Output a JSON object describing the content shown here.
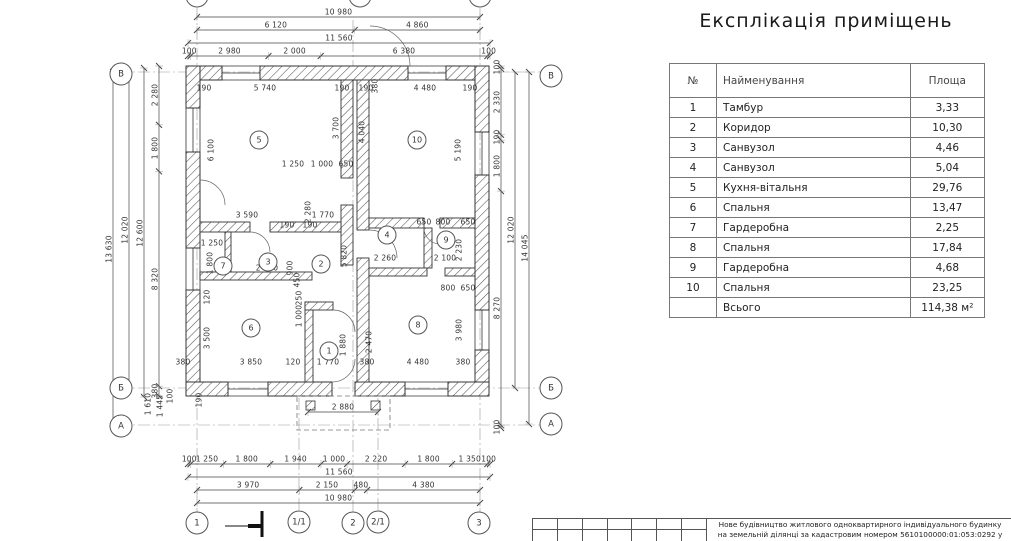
{
  "title": "Експлікація приміщень",
  "table": {
    "headers": [
      "№",
      "Найменування",
      "Площа"
    ],
    "rows": [
      [
        "1",
        "Тамбур",
        "3,33"
      ],
      [
        "2",
        "Коридор",
        "10,30"
      ],
      [
        "3",
        "Санвузол",
        "4,46"
      ],
      [
        "4",
        "Санвузол",
        "5,04"
      ],
      [
        "5",
        "Кухня-вітальня",
        "29,76"
      ],
      [
        "6",
        "Спальня",
        "13,47"
      ],
      [
        "7",
        "Гардеробна",
        "2,25"
      ],
      [
        "8",
        "Спальня",
        "17,84"
      ],
      [
        "9",
        "Гардеробна",
        "4,68"
      ],
      [
        "10",
        "Спальня",
        "23,25"
      ]
    ],
    "footer": {
      "label": "Всього",
      "value": "114,38 м²"
    }
  },
  "title_block": {
    "line1": "Нове будівництво житлового одноквартирного індивідуального будинку",
    "line2": "на земельній ділянці за кадастровим номером 5610100000:01:053:0292 у"
  },
  "chains": [
    {
      "dir": "h",
      "y": 17,
      "a": 197,
      "b": 480,
      "vals": [
        "10 980"
      ]
    },
    {
      "dir": "h",
      "y": 30,
      "a": 197,
      "b": 480,
      "vals": [
        "6 120",
        "4 860"
      ]
    },
    {
      "dir": "h",
      "y": 43,
      "a": 188,
      "b": 490,
      "vals": [
        "11 560"
      ]
    },
    {
      "dir": "h",
      "y": 56,
      "a": 188,
      "b": 490,
      "vals": [
        "100",
        "2 980",
        "2 000",
        "6 380",
        "100"
      ]
    },
    {
      "dir": "h",
      "y": 412,
      "a": 308,
      "b": 378,
      "vals": [
        "2 880"
      ]
    },
    {
      "dir": "h",
      "y": 464,
      "a": 188,
      "b": 490,
      "vals": [
        "100",
        "1 250",
        "1 800",
        "1 940",
        "1 000",
        "2 220",
        "1 800",
        "1 350",
        "100"
      ]
    },
    {
      "dir": "h",
      "y": 477,
      "a": 188,
      "b": 490,
      "vals": [
        "11 560"
      ]
    },
    {
      "dir": "h",
      "y": 490,
      "a": 197,
      "b": 480,
      "vals": [
        "3 970",
        "2 150",
        "480",
        "4 380"
      ]
    },
    {
      "dir": "h",
      "y": 503,
      "a": 197,
      "b": 480,
      "vals": [
        "10 980"
      ]
    },
    {
      "dir": "v",
      "x": 113,
      "a": 72,
      "b": 426,
      "vals": [
        "13 630"
      ]
    },
    {
      "dir": "v",
      "x": 129,
      "a": 72,
      "b": 388,
      "vals": [
        "12 020"
      ]
    },
    {
      "dir": "v",
      "x": 144,
      "a": 68,
      "b": 397,
      "vals": [
        "12 600"
      ]
    },
    {
      "dir": "v",
      "x": 159,
      "a": 66,
      "b": 396,
      "vals": [
        "2 280",
        "1 800",
        "8 320",
        "380"
      ]
    },
    {
      "dir": "v",
      "x": 501,
      "a": 66,
      "b": 428,
      "vals": [
        "100",
        "2 330",
        "190",
        "1 800",
        "8 270",
        "100"
      ]
    },
    {
      "dir": "v",
      "x": 515,
      "a": 72,
      "b": 388,
      "vals": [
        "12 020"
      ]
    },
    {
      "dir": "v",
      "x": 529,
      "a": 72,
      "b": 424,
      "vals": [
        "14 045"
      ]
    }
  ],
  "labels": [
    {
      "t": "190",
      "x": 204,
      "y": 92
    },
    {
      "t": "5 740",
      "x": 265,
      "y": 92
    },
    {
      "t": "190",
      "x": 342,
      "y": 92
    },
    {
      "t": "190",
      "x": 366,
      "y": 92
    },
    {
      "t": "4 480",
      "x": 425,
      "y": 92
    },
    {
      "t": "190",
      "x": 470,
      "y": 92
    },
    {
      "t": "380",
      "x": 375,
      "y": 86,
      "r": 1
    },
    {
      "t": "1 250",
      "x": 293,
      "y": 168
    },
    {
      "t": "1 000",
      "x": 322,
      "y": 168
    },
    {
      "t": "650",
      "x": 346,
      "y": 168
    },
    {
      "t": "3 590",
      "x": 247,
      "y": 219
    },
    {
      "t": "1 770",
      "x": 323,
      "y": 219
    },
    {
      "t": "190",
      "x": 287,
      "y": 229
    },
    {
      "t": "190",
      "x": 310,
      "y": 229
    },
    {
      "t": "1 250",
      "x": 212,
      "y": 247
    },
    {
      "t": "2 480",
      "x": 267,
      "y": 272
    },
    {
      "t": "2 260",
      "x": 385,
      "y": 262
    },
    {
      "t": "2 100",
      "x": 445,
      "y": 262
    },
    {
      "t": "650",
      "x": 424,
      "y": 226
    },
    {
      "t": "800",
      "x": 443,
      "y": 226
    },
    {
      "t": "650",
      "x": 468,
      "y": 226
    },
    {
      "t": "800",
      "x": 448,
      "y": 292
    },
    {
      "t": "650",
      "x": 468,
      "y": 292
    },
    {
      "t": "380",
      "x": 183,
      "y": 366
    },
    {
      "t": "3 850",
      "x": 251,
      "y": 366
    },
    {
      "t": "120",
      "x": 293,
      "y": 366
    },
    {
      "t": "1 770",
      "x": 328,
      "y": 366
    },
    {
      "t": "380",
      "x": 367,
      "y": 366
    },
    {
      "t": "4 480",
      "x": 418,
      "y": 366
    },
    {
      "t": "380",
      "x": 463,
      "y": 366
    },
    {
      "t": "6 100",
      "x": 211,
      "y": 150,
      "r": 1
    },
    {
      "t": "3 700",
      "x": 336,
      "y": 128,
      "r": 1
    },
    {
      "t": "4 040",
      "x": 362,
      "y": 132,
      "r": 1
    },
    {
      "t": "5 190",
      "x": 458,
      "y": 150,
      "r": 1
    },
    {
      "t": "2 280",
      "x": 308,
      "y": 212,
      "r": 1
    },
    {
      "t": "5 820",
      "x": 344,
      "y": 256,
      "r": 1
    },
    {
      "t": "2 230",
      "x": 459,
      "y": 250,
      "r": 1
    },
    {
      "t": "1 800",
      "x": 210,
      "y": 263,
      "r": 1
    },
    {
      "t": "120",
      "x": 207,
      "y": 297,
      "r": 1
    },
    {
      "t": "3 500",
      "x": 207,
      "y": 338,
      "r": 1
    },
    {
      "t": "900",
      "x": 290,
      "y": 268,
      "r": 1
    },
    {
      "t": "450",
      "x": 297,
      "y": 280,
      "r": 1
    },
    {
      "t": "250",
      "x": 299,
      "y": 298,
      "r": 1
    },
    {
      "t": "1 000",
      "x": 299,
      "y": 316,
      "r": 1
    },
    {
      "t": "1 880",
      "x": 343,
      "y": 345,
      "r": 1
    },
    {
      "t": "2 470",
      "x": 369,
      "y": 342,
      "r": 1
    },
    {
      "t": "3 980",
      "x": 459,
      "y": 330,
      "r": 1
    },
    {
      "t": "1 610",
      "x": 148,
      "y": 404,
      "r": 1
    },
    {
      "t": "1 445",
      "x": 160,
      "y": 406,
      "r": 1
    },
    {
      "t": "100",
      "x": 170,
      "y": 396,
      "r": 1
    },
    {
      "t": "190",
      "x": 199,
      "y": 400,
      "r": 1
    }
  ],
  "axis_bubbles": [
    {
      "t": "В",
      "x": 121,
      "y": 74
    },
    {
      "t": "Б",
      "x": 121,
      "y": 388
    },
    {
      "t": "А",
      "x": 121,
      "y": 426
    },
    {
      "t": "В",
      "x": 551,
      "y": 76
    },
    {
      "t": "Б",
      "x": 551,
      "y": 388
    },
    {
      "t": "А",
      "x": 551,
      "y": 424
    },
    {
      "t": "1",
      "x": 197,
      "y": 523
    },
    {
      "t": "1/1",
      "x": 299,
      "y": 522
    },
    {
      "t": "2",
      "x": 353,
      "y": 523
    },
    {
      "t": "2/1",
      "x": 378,
      "y": 522
    },
    {
      "t": "3",
      "x": 479,
      "y": 523
    },
    {
      "t": "",
      "x": 197,
      "y": -4
    },
    {
      "t": "",
      "x": 360,
      "y": -4
    },
    {
      "t": "",
      "x": 480,
      "y": -4
    }
  ],
  "room_bubbles": [
    {
      "t": "5",
      "x": 259,
      "y": 140
    },
    {
      "t": "10",
      "x": 417,
      "y": 140
    },
    {
      "t": "7",
      "x": 223,
      "y": 266
    },
    {
      "t": "3",
      "x": 268,
      "y": 262
    },
    {
      "t": "2",
      "x": 321,
      "y": 264
    },
    {
      "t": "4",
      "x": 387,
      "y": 235
    },
    {
      "t": "9",
      "x": 446,
      "y": 240
    },
    {
      "t": "6",
      "x": 251,
      "y": 328
    },
    {
      "t": "1",
      "x": 329,
      "y": 351
    },
    {
      "t": "8",
      "x": 418,
      "y": 325
    }
  ],
  "colors": {
    "line": "#444444",
    "text": "#333333",
    "wall_hatch": "#555555"
  }
}
